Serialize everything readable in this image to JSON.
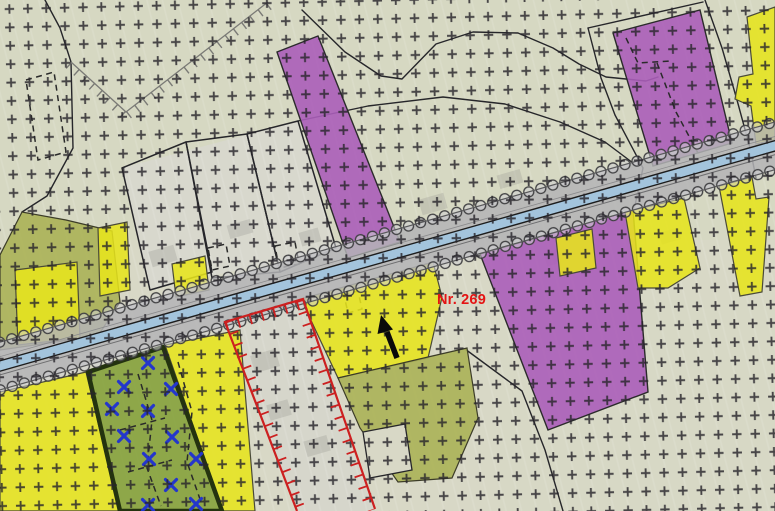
{
  "map": {
    "parcel_label": "Nr. 269",
    "colors": {
      "background": "#d8d8c6",
      "parcel-yellow": "#e6e41c",
      "parcel-olive": "#abb257",
      "parcel-green": "#8aa442",
      "green-border": "#24330f",
      "parcel-purple": "#ab5eb9",
      "road-fill": "#b4b4b6",
      "road-stripe": "#a3c4dc",
      "boundary-red": "#cc2020",
      "label-red": "#e41414",
      "mark-blue": "#2436cc",
      "grid-cross": "#26242a",
      "line-black": "#26262a",
      "hachure-gray": "#7a7a76"
    },
    "x_marks": [
      [
        148,
        363
      ],
      [
        124,
        387
      ],
      [
        171,
        389
      ],
      [
        112,
        409
      ],
      [
        148,
        411
      ],
      [
        124,
        436
      ],
      [
        172,
        437
      ],
      [
        149,
        459
      ],
      [
        196,
        459
      ],
      [
        171,
        485
      ],
      [
        148,
        505
      ],
      [
        196,
        504
      ]
    ]
  }
}
